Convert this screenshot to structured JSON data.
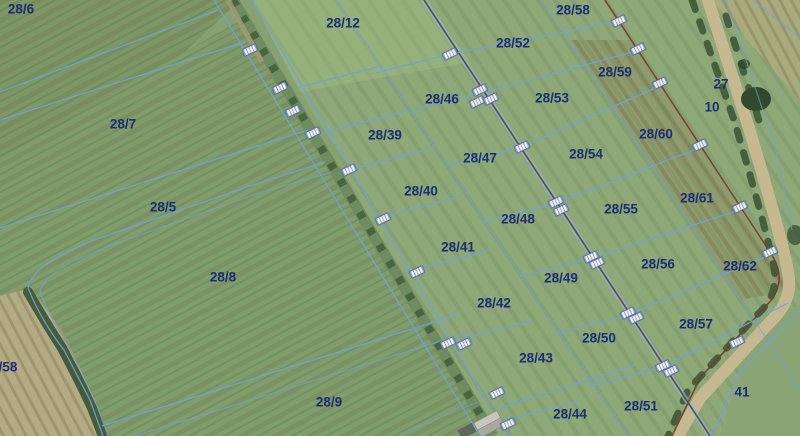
{
  "map": {
    "type": "aerial-cadastral-map",
    "colors": {
      "base_green": "#87a173",
      "field_dark": "#7d9766",
      "field_tan": "#b3ab84",
      "track_green": "#6f8c60",
      "tree_dark": "#3a5433",
      "road_tan": "#c6b992",
      "parcel_line_blue": "#6fa3d8",
      "boundary_dark": "#57514b",
      "boundary_maroon": "#7c3a2a",
      "label_navy": "#1c2d74",
      "marker_white": "#f2efe6"
    },
    "parcel_labels": [
      {
        "text": "28/6",
        "x": 21,
        "y": 9
      },
      {
        "text": "28/12",
        "x": 343,
        "y": 23
      },
      {
        "text": "28/58",
        "x": 573,
        "y": 10
      },
      {
        "text": "28/52",
        "x": 513,
        "y": 43
      },
      {
        "text": "28/59",
        "x": 615,
        "y": 72
      },
      {
        "text": "27",
        "x": 721,
        "y": 84
      },
      {
        "text": "28/46",
        "x": 442,
        "y": 99
      },
      {
        "text": "28/53",
        "x": 552,
        "y": 98
      },
      {
        "text": "10",
        "x": 712,
        "y": 107
      },
      {
        "text": "28/7",
        "x": 123,
        "y": 124
      },
      {
        "text": "28/39",
        "x": 385,
        "y": 135
      },
      {
        "text": "28/60",
        "x": 656,
        "y": 134
      },
      {
        "text": "28/54",
        "x": 586,
        "y": 154
      },
      {
        "text": "28/47",
        "x": 480,
        "y": 158
      },
      {
        "text": "28/40",
        "x": 421,
        "y": 191
      },
      {
        "text": "28/61",
        "x": 697,
        "y": 198
      },
      {
        "text": "28/5",
        "x": 163,
        "y": 207
      },
      {
        "text": "28/55",
        "x": 621,
        "y": 209
      },
      {
        "text": "28/48",
        "x": 518,
        "y": 219
      },
      {
        "text": "28/41",
        "x": 458,
        "y": 247
      },
      {
        "text": "28/56",
        "x": 658,
        "y": 264
      },
      {
        "text": "28/62",
        "x": 740,
        "y": 266
      },
      {
        "text": "28/8",
        "x": 223,
        "y": 277
      },
      {
        "text": "28/49",
        "x": 561,
        "y": 278
      },
      {
        "text": "28/42",
        "x": 494,
        "y": 303
      },
      {
        "text": "28/57",
        "x": 696,
        "y": 324
      },
      {
        "text": "28/50",
        "x": 599,
        "y": 338
      },
      {
        "text": "28/43",
        "x": 536,
        "y": 358
      },
      {
        "text": "/58",
        "x": 8,
        "y": 367
      },
      {
        "text": "41",
        "x": 742,
        "y": 392
      },
      {
        "text": "28/9",
        "x": 329,
        "y": 402
      },
      {
        "text": "28/51",
        "x": 641,
        "y": 406
      },
      {
        "text": "28/44",
        "x": 570,
        "y": 414
      }
    ],
    "markers": [
      {
        "x": 250,
        "y": 50
      },
      {
        "x": 280,
        "y": 88
      },
      {
        "x": 293,
        "y": 111
      },
      {
        "x": 313,
        "y": 133
      },
      {
        "x": 349,
        "y": 170
      },
      {
        "x": 383,
        "y": 219
      },
      {
        "x": 417,
        "y": 272
      },
      {
        "x": 448,
        "y": 343
      },
      {
        "x": 464,
        "y": 344
      },
      {
        "x": 497,
        "y": 393
      },
      {
        "x": 508,
        "y": 424
      },
      {
        "x": 450,
        "y": 54
      },
      {
        "x": 480,
        "y": 90
      },
      {
        "x": 477,
        "y": 102
      },
      {
        "x": 491,
        "y": 99
      },
      {
        "x": 522,
        "y": 147
      },
      {
        "x": 556,
        "y": 202
      },
      {
        "x": 561,
        "y": 210
      },
      {
        "x": 591,
        "y": 257
      },
      {
        "x": 597,
        "y": 263
      },
      {
        "x": 628,
        "y": 313
      },
      {
        "x": 636,
        "y": 318
      },
      {
        "x": 663,
        "y": 366
      },
      {
        "x": 671,
        "y": 371
      },
      {
        "x": 619,
        "y": 21
      },
      {
        "x": 638,
        "y": 49
      },
      {
        "x": 660,
        "y": 83
      },
      {
        "x": 700,
        "y": 145
      },
      {
        "x": 740,
        "y": 207
      },
      {
        "x": 770,
        "y": 252
      },
      {
        "x": 737,
        "y": 342
      }
    ]
  }
}
